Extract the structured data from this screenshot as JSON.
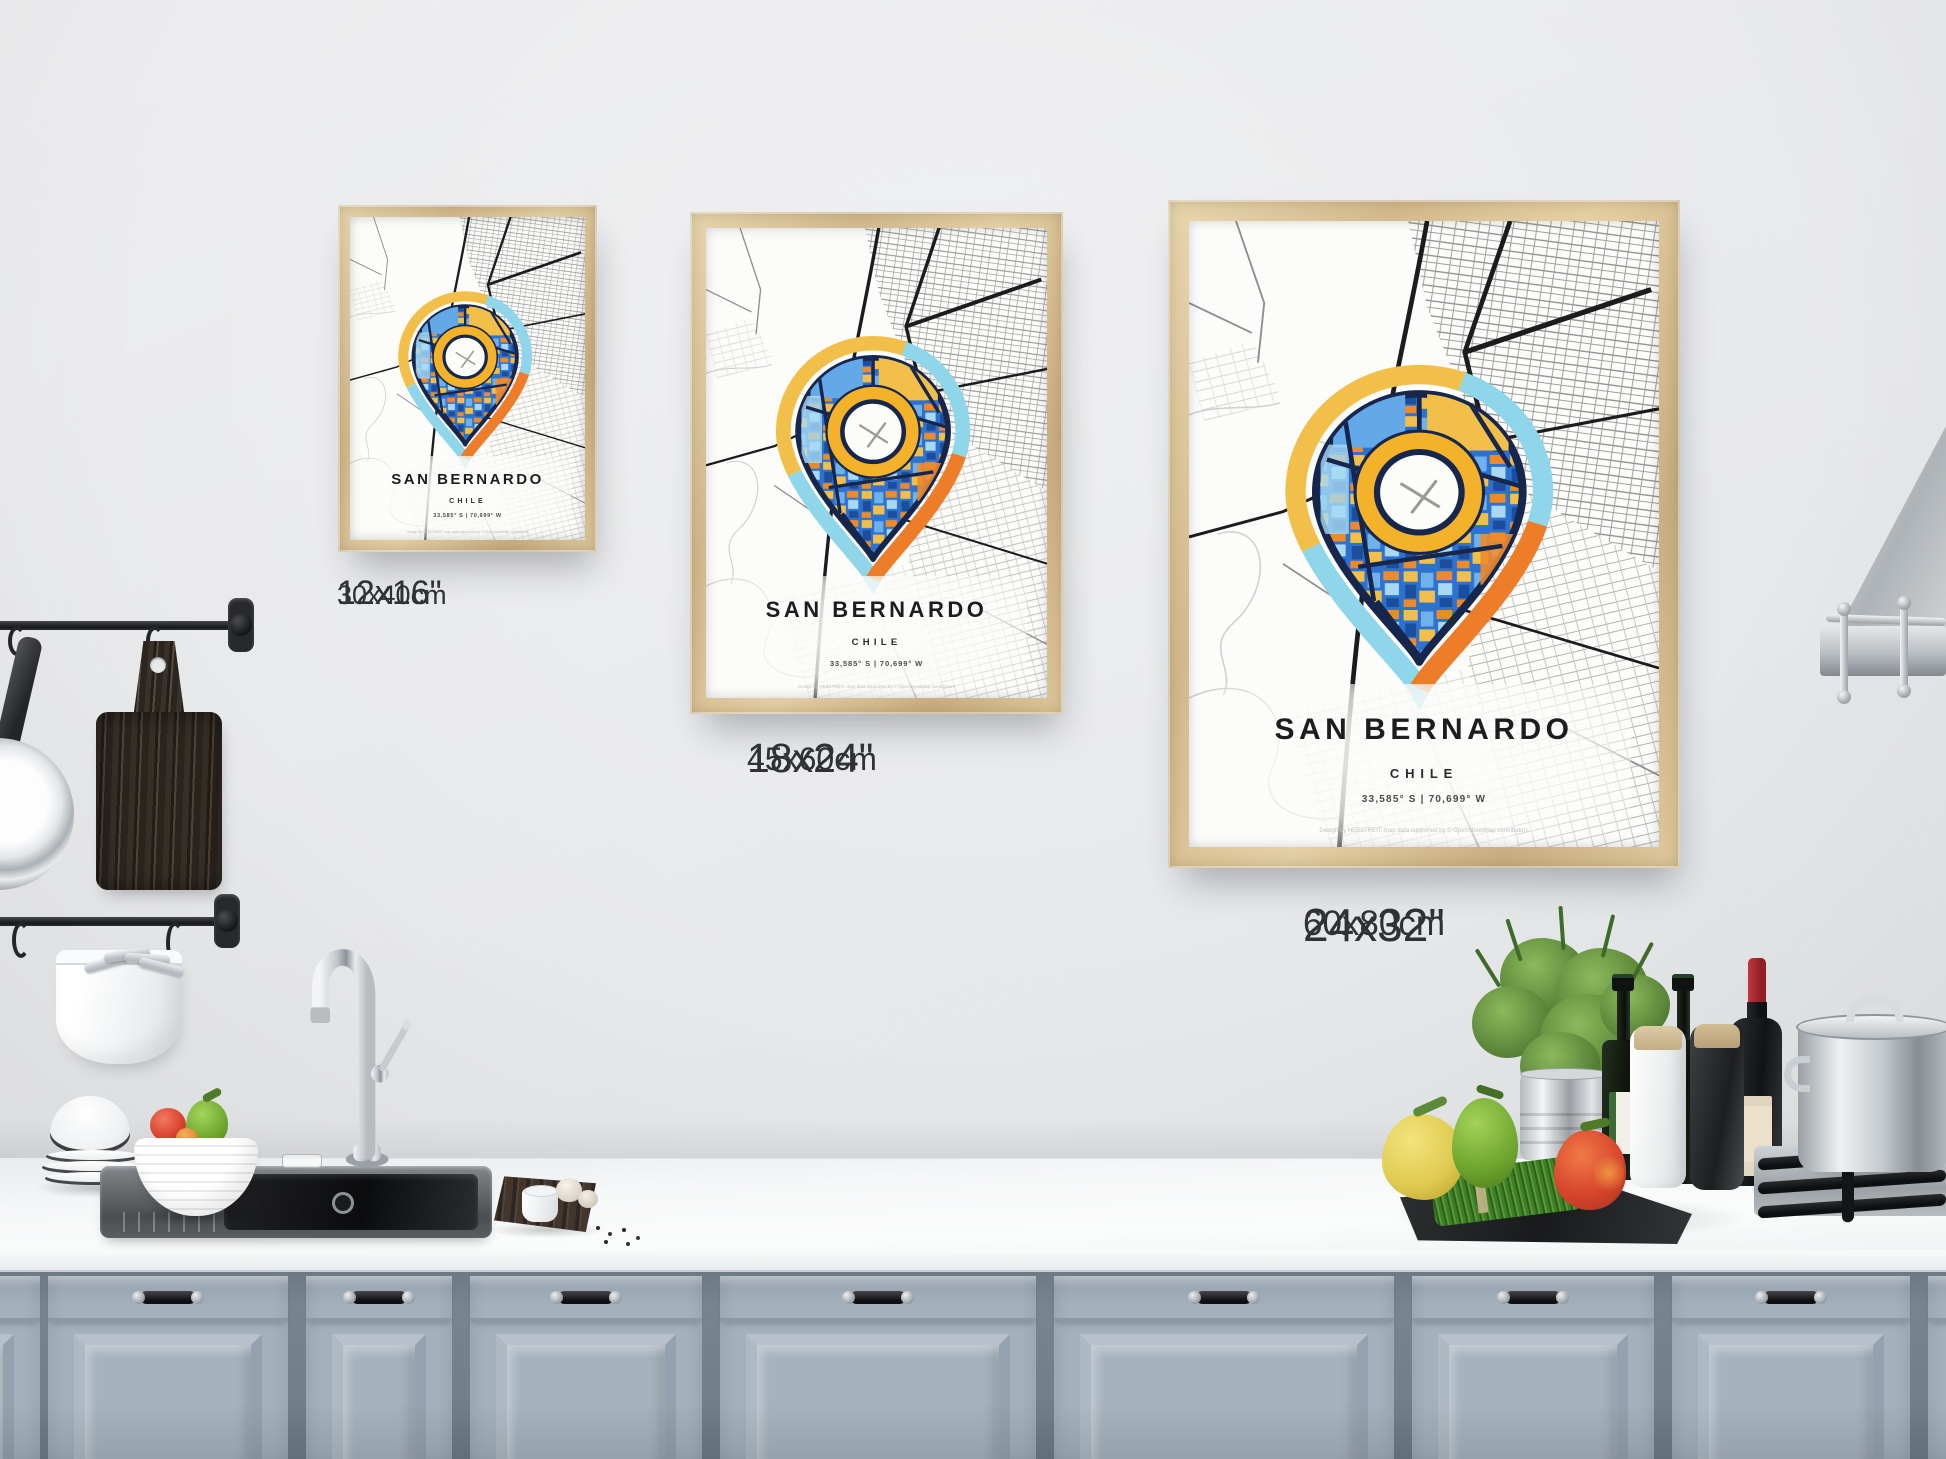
{
  "poster": {
    "city": "SAN BERNARDO",
    "country": "CHILE",
    "coordinates": "33,585° S | 70,699° W",
    "credit": "Design by HEBSTREIT, map data supported by © OpenStreetMap contributors"
  },
  "size_labels": [
    {
      "inches": "12x16\"",
      "cm": "30x40cm"
    },
    {
      "inches": "18x24\"",
      "cm": "45x60cm"
    },
    {
      "inches": "24x32\"",
      "cm": "60x80cm"
    }
  ],
  "colors": {
    "pin_yellow": "#f2c04a",
    "pin_cyan": "#8fd6ea",
    "pin_orange": "#ee7d2a",
    "pin_navy": "#16264d",
    "pin_blue": "#2e72cf",
    "frame_wood": "#d8c094",
    "cabinet_blue_gray": "#a3b1bd",
    "wall_gray": "#e9eaec"
  }
}
